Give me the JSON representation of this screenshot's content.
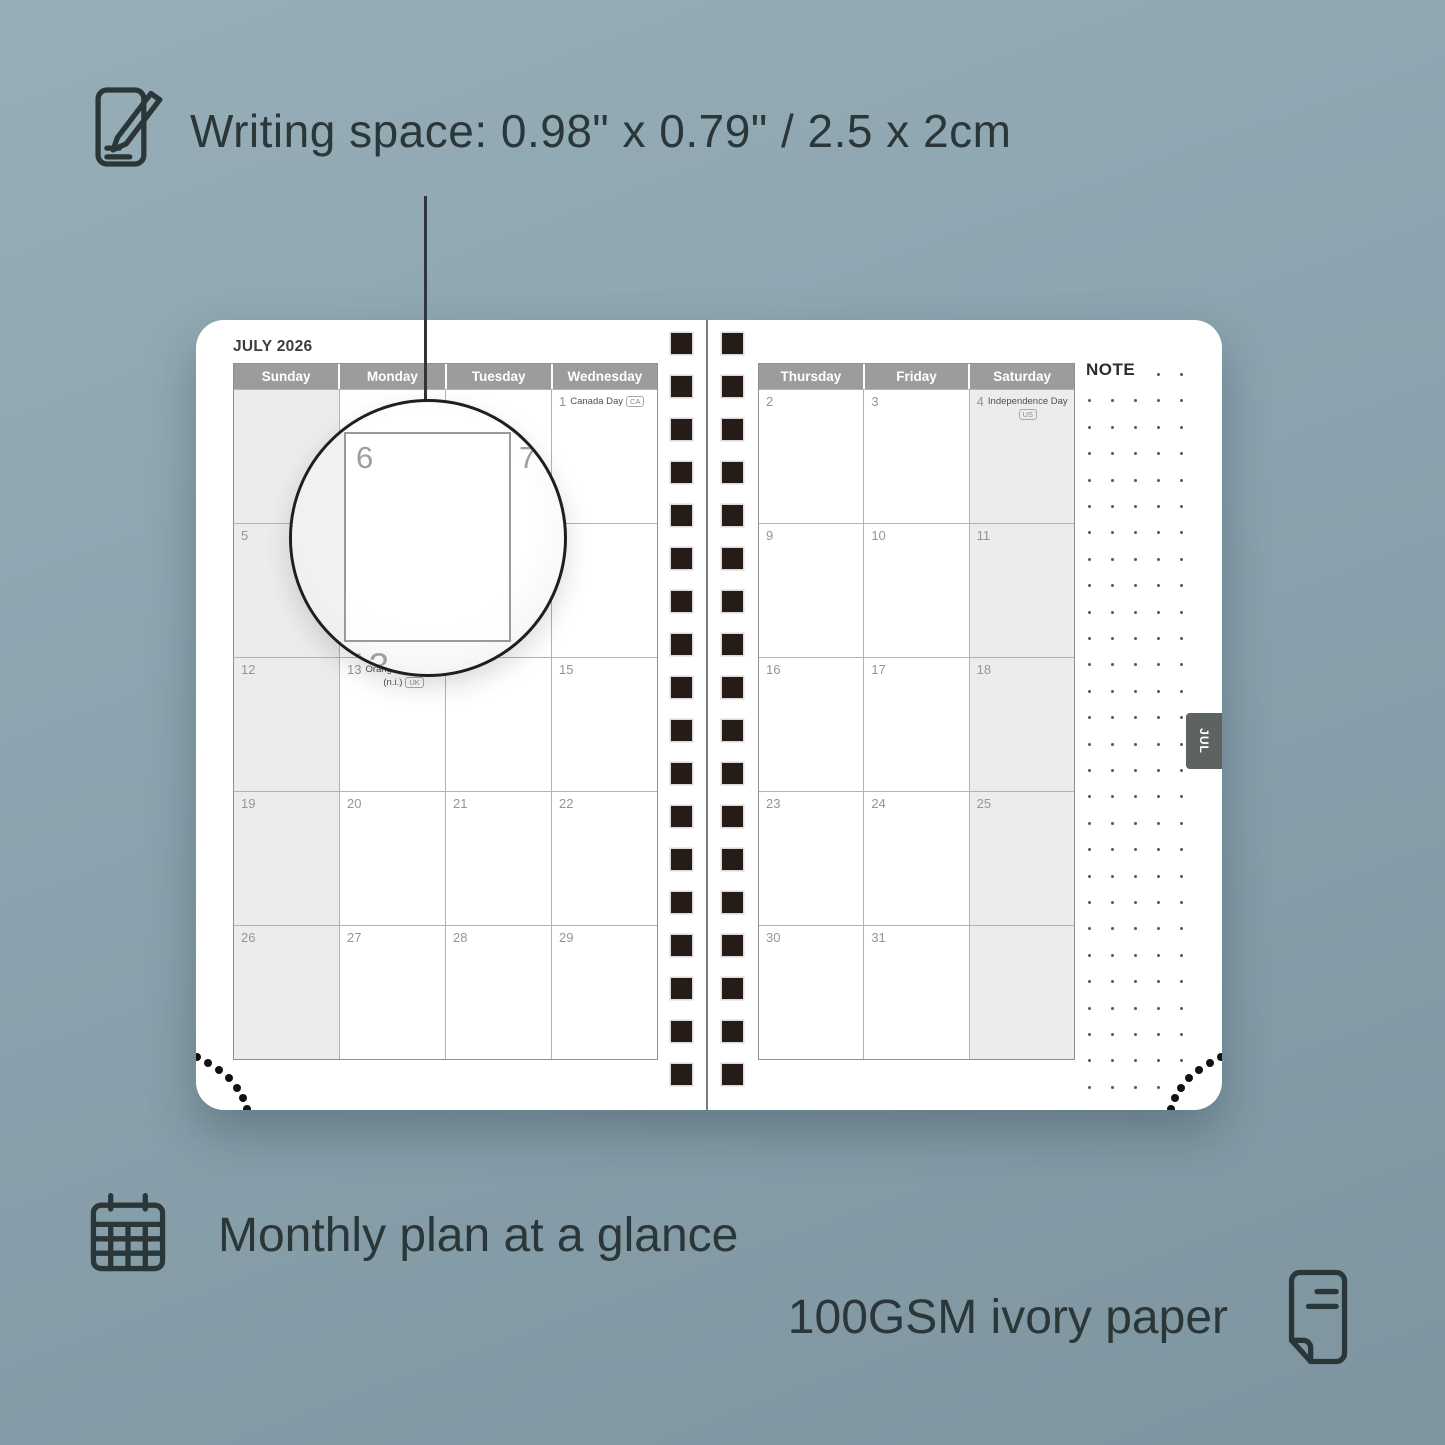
{
  "captions": {
    "writing_space": "Writing space: 0.98\" x 0.79\" / 2.5 x 2cm",
    "monthly_plan": "Monthly plan at a glance",
    "paper": "100GSM ivory paper"
  },
  "planner": {
    "title": "JULY 2026",
    "note_label": "NOTE",
    "tab_label": "JUL",
    "left_day_headers": [
      "Sunday",
      "Monday",
      "Tuesday",
      "Wednesday"
    ],
    "right_day_headers": [
      "Thursday",
      "Friday",
      "Saturday"
    ],
    "weeks_left": [
      [
        {
          "day": ""
        },
        {
          "day": ""
        },
        {
          "day": ""
        },
        {
          "day": "1",
          "holiday": "Canada Day",
          "badge": "CA",
          "badge_pos": "inline"
        }
      ],
      [
        {
          "day": "5"
        },
        {
          "day": "6"
        },
        {
          "day": "7"
        },
        {
          "day": ""
        }
      ],
      [
        {
          "day": "12"
        },
        {
          "day": "13",
          "holiday": "Orangemen's Day",
          "note": "(n.i.)",
          "badge": "UK",
          "badge_pos": "below"
        },
        {
          "day": ""
        },
        {
          "day": "15"
        }
      ],
      [
        {
          "day": "19"
        },
        {
          "day": "20"
        },
        {
          "day": "21"
        },
        {
          "day": "22"
        }
      ],
      [
        {
          "day": "26"
        },
        {
          "day": "27"
        },
        {
          "day": "28"
        },
        {
          "day": "29"
        }
      ]
    ],
    "weeks_right": [
      [
        {
          "day": "2"
        },
        {
          "day": "3"
        },
        {
          "day": "4",
          "holiday": "Independence Day",
          "badge": "US",
          "badge_pos": "below"
        }
      ],
      [
        {
          "day": "9"
        },
        {
          "day": "10"
        },
        {
          "day": "11"
        }
      ],
      [
        {
          "day": "16"
        },
        {
          "day": "17"
        },
        {
          "day": "18"
        }
      ],
      [
        {
          "day": "23"
        },
        {
          "day": "24"
        },
        {
          "day": "25"
        }
      ],
      [
        {
          "day": "30"
        },
        {
          "day": "31"
        },
        {
          "day": ""
        }
      ]
    ],
    "magnifier": {
      "day_left": "6",
      "day_right": "7",
      "partial_bottom": "13"
    },
    "note_grid": {
      "cols": 5,
      "rows": 28
    },
    "binding_holes_per_column": 18
  },
  "colors": {
    "bg1": "#97aeb8",
    "bg2": "#7e95a0",
    "ink": "#2b3639",
    "paper": "#ffffff",
    "headerbg": "#9c9c9c",
    "shade": "#ececec",
    "hole": "#261b16",
    "tabbg": "#5d6360",
    "gridline": "#b3b3b3",
    "calborder": "#8f8f8f",
    "daynum": "#959595",
    "holidaytext": "#4f4f4f"
  }
}
